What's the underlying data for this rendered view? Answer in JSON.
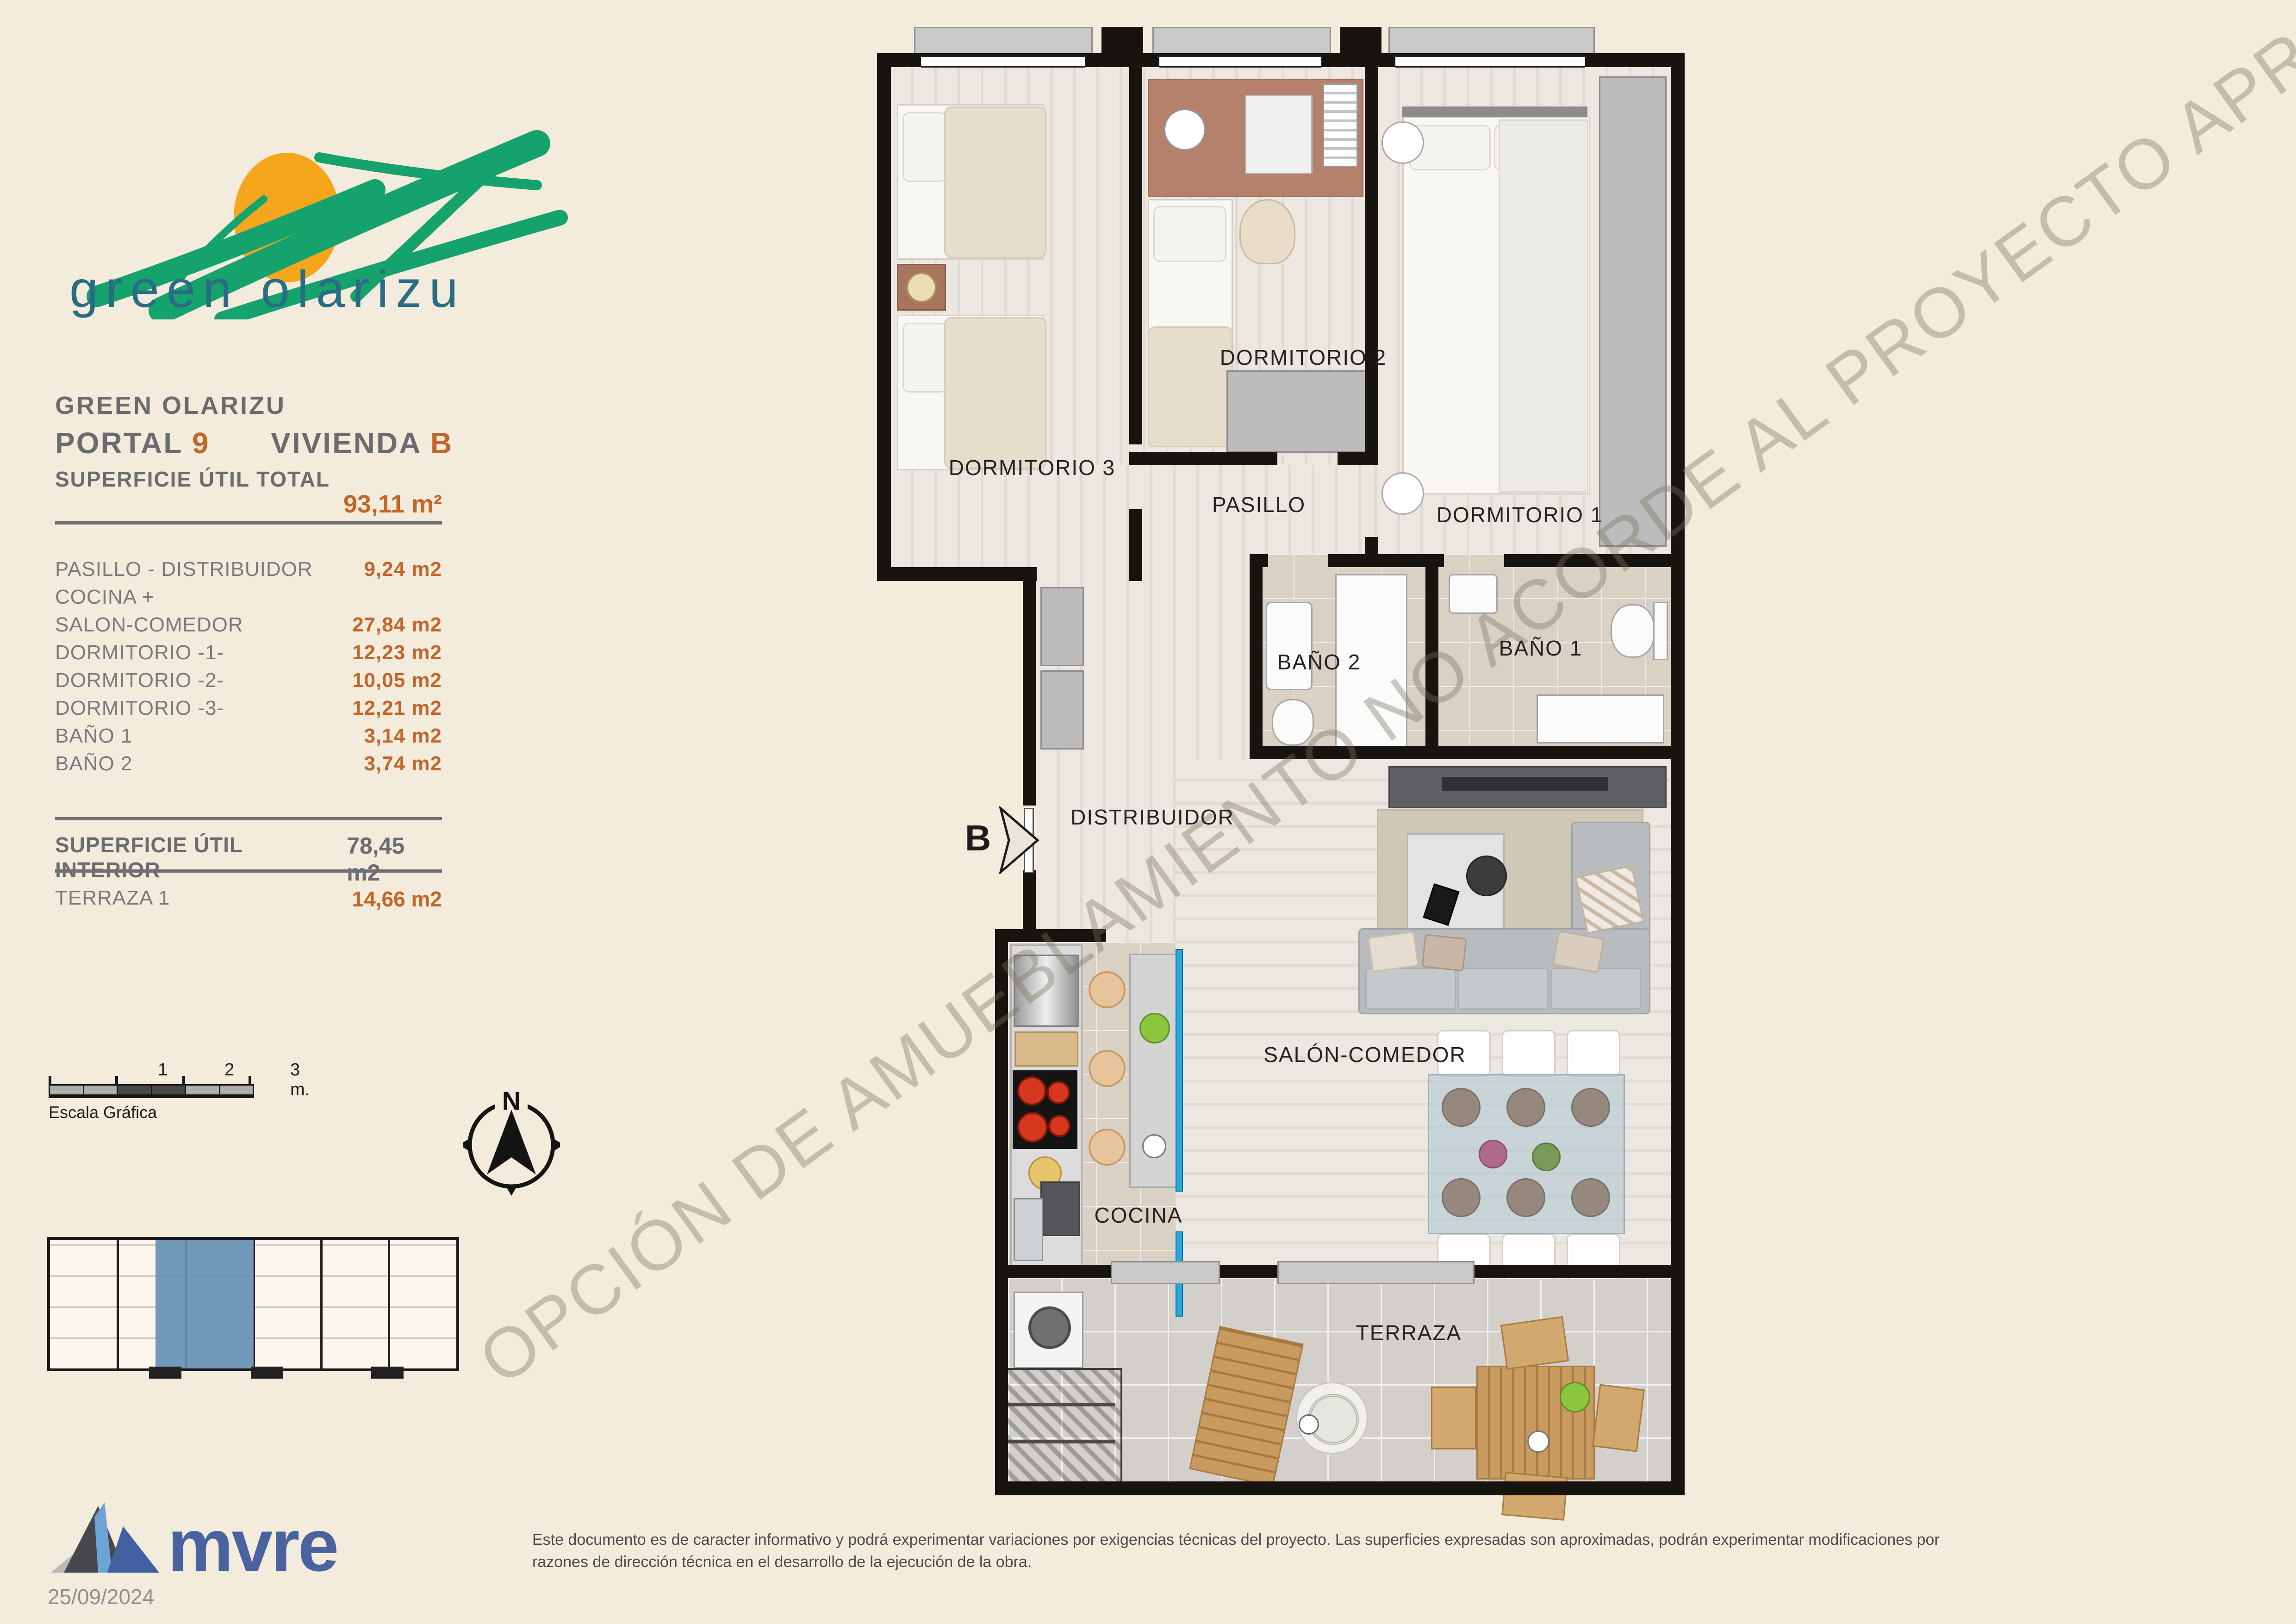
{
  "brand": {
    "logo_text": "green olarizu"
  },
  "header": {
    "project": "GREEN OLARIZU",
    "portal_label": "PORTAL",
    "portal_number": "9",
    "vivienda_label": "VIVIENDA",
    "vivienda_letter": "B"
  },
  "areas": {
    "total_label": "SUPERFICIE ÚTIL TOTAL",
    "total_value": "93,11 m²",
    "rows": [
      {
        "label": "PASILLO - DISTRIBUIDOR",
        "value": "9,24 m2"
      },
      {
        "label": "COCINA +",
        "value": ""
      },
      {
        "label": "SALON-COMEDOR",
        "value": "27,84 m2"
      },
      {
        "label": "DORMITORIO -1-",
        "value": "12,23 m2"
      },
      {
        "label": "DORMITORIO -2-",
        "value": "10,05 m2"
      },
      {
        "label": "DORMITORIO -3-",
        "value": "12,21 m2"
      },
      {
        "label": "BAÑO 1",
        "value": "3,14 m2"
      },
      {
        "label": "BAÑO 2",
        "value": "3,74 m2"
      }
    ],
    "interior_label": "SUPERFICIE ÚTIL INTERIOR",
    "interior_value": "78,45 m2",
    "terraza_label": "TERRAZA 1",
    "terraza_value": "14,66 m2"
  },
  "scalebar": {
    "tick1": "1",
    "tick2": "2",
    "tick3": "3 m.",
    "caption": "Escala Gráfica"
  },
  "compass": {
    "north": "N"
  },
  "plan": {
    "watermark": "OPCIÓN DE AMUEBLAMIENTO NO ACORDE AL PROYECTO APROBADO",
    "entrance_letter": "B",
    "labels": {
      "dormitorio3": "DORMITORIO 3",
      "dormitorio2": "DORMITORIO 2",
      "dormitorio1": "DORMITORIO 1",
      "pasillo": "PASILLO",
      "bano2": "BAÑO 2",
      "bano1": "BAÑO 1",
      "distribuidor": "DISTRIBUIDOR",
      "salon": "SALÓN-COMEDOR",
      "cocina": "COCINA",
      "terraza": "TERRAZA"
    }
  },
  "footer": {
    "logo_text": "mvre",
    "date": "25/09/2024",
    "disclaimer_line1": "Este documento es de caracter informativo y podrá experimentar variaciones por exigencias técnicas del proyecto. Las superficies expresadas son aproximadas, podrán experimentar modificaciones por",
    "disclaimer_line2": "razones de dirección técnica en el desarrollo de la ejecución de la obra."
  },
  "colors": {
    "accent_orange": "#c3662a",
    "brand_green": "#16a26c",
    "brand_teal": "#2a6b85",
    "mvre_blue": "#4a63a0",
    "keyplan_highlight": "#6690b4",
    "counter_blue": "#29a8df"
  }
}
